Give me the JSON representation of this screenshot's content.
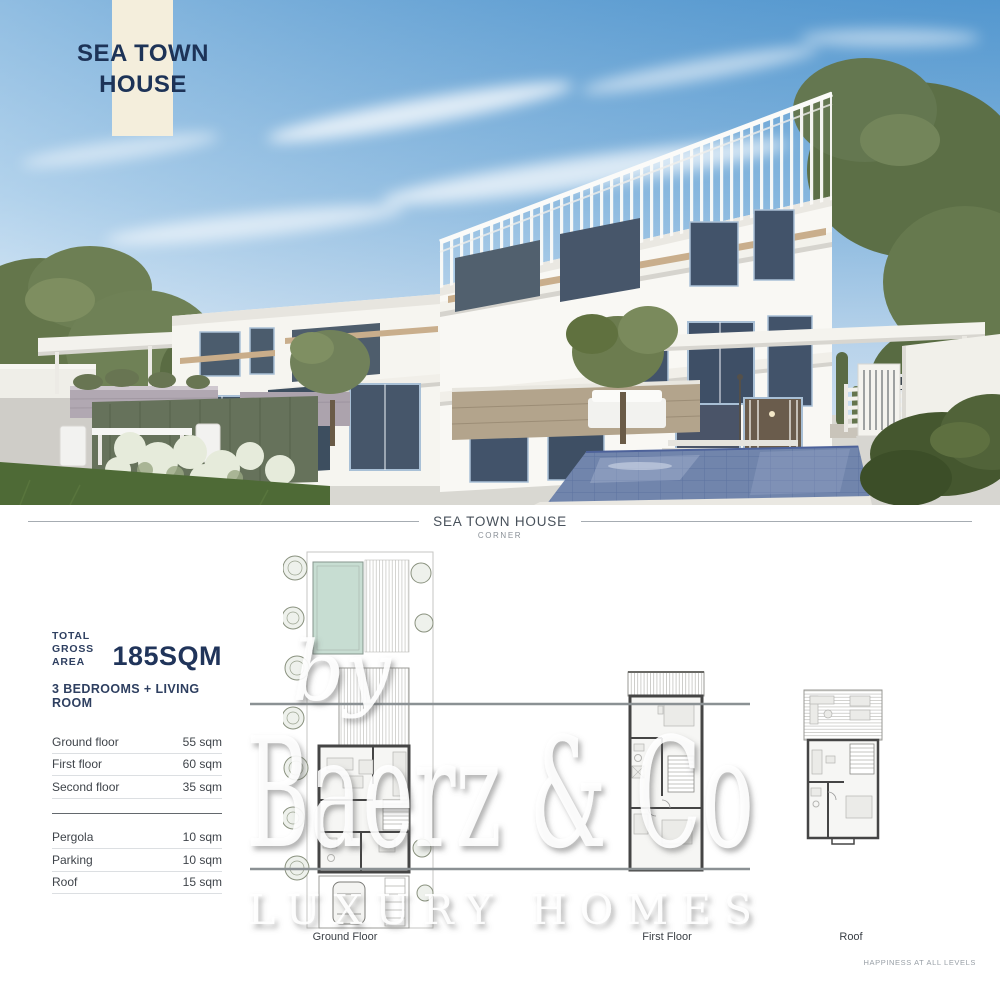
{
  "hero": {
    "title_line1": "SEA TOWN",
    "title_line2": "HOUSE",
    "band_color": "#f4eedc",
    "title_color": "#1d3357"
  },
  "section_header": {
    "title": "SEA TOWN HOUSE",
    "subtitle": "CORNER"
  },
  "summary": {
    "total_line1": "TOTAL",
    "total_line2": "GROSS AREA",
    "total_value": "185SQM",
    "bedrooms": "3 BEDROOMS + LIVING ROOM"
  },
  "area_table": {
    "floors": [
      {
        "label": "Ground floor",
        "value": "55 sqm"
      },
      {
        "label": "First floor",
        "value": "60 sqm"
      },
      {
        "label": "Second floor",
        "value": "35 sqm"
      }
    ],
    "extras": [
      {
        "label": "Pergola",
        "value": "10 sqm"
      },
      {
        "label": "Parking",
        "value": "10 sqm"
      },
      {
        "label": "Roof",
        "value": "15 sqm"
      }
    ]
  },
  "floor_plans": {
    "ground": "Ground Floor",
    "first": "First Floor",
    "roof": "Roof"
  },
  "watermark": {
    "by": "by",
    "brand": "Baerz & Co",
    "tagline": "LUXURY HOMES"
  },
  "footer": {
    "tagline": "HAPPINESS AT ALL LEVELS"
  },
  "colors": {
    "accent_navy": "#1d3357",
    "cream_band": "#f4eedc",
    "sky_top": "#559ad2",
    "sky_horizon": "#e2eef8",
    "pool": "#7185ac",
    "plan_pool": "#c7ddd2"
  }
}
